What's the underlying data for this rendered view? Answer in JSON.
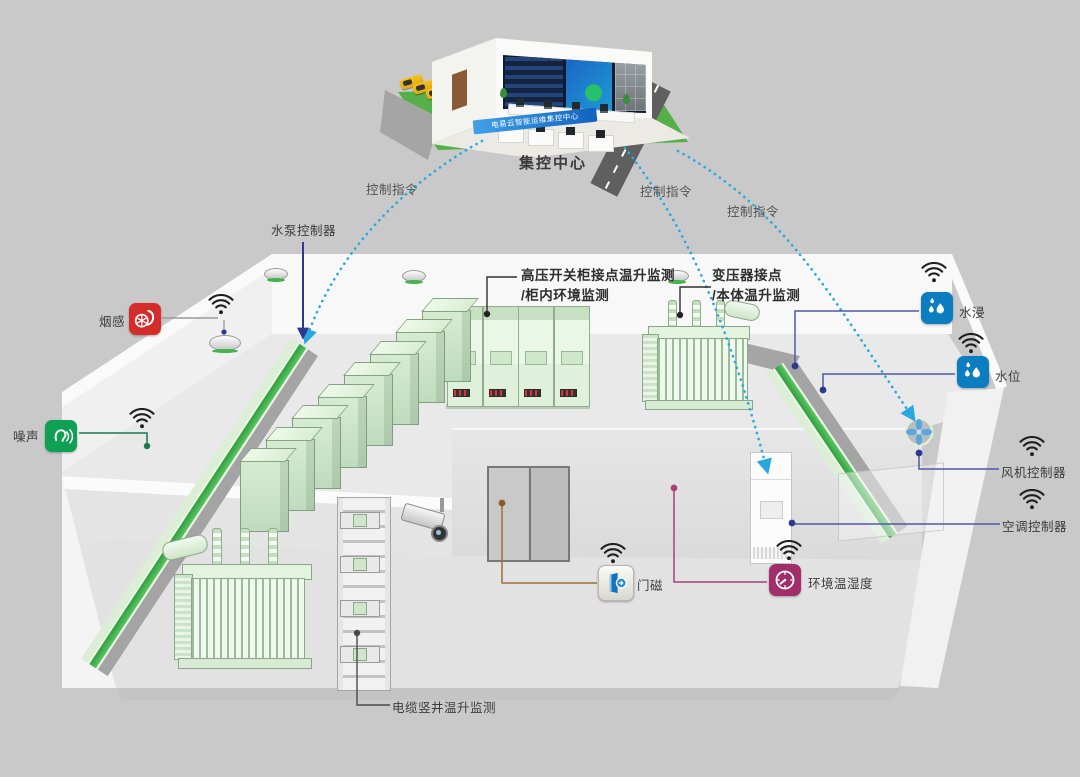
{
  "control_center": {
    "label": "集控中心",
    "banner": "电易云智能运维集控中心"
  },
  "commands": {
    "label": "控制指令"
  },
  "callouts": {
    "water_pump": {
      "label": "水泵控制器"
    },
    "smoke": {
      "label": "烟感"
    },
    "noise": {
      "label": "噪声"
    },
    "hv_cabinet": {
      "line1": "高压开关柜接点温升监测",
      "line2": "/柜内环境监测"
    },
    "transformer": {
      "line1": "变压器接点",
      "line2": "/本体温升监测"
    },
    "water_immersion": {
      "label": "水浸"
    },
    "water_level": {
      "label": "水位"
    },
    "fan": {
      "label": "风机控制器"
    },
    "ac": {
      "label": "空调控制器"
    },
    "door": {
      "label": "门磁"
    },
    "env": {
      "label": "环境温湿度"
    },
    "cable_shaft": {
      "label": "电缆竖井温升监测"
    }
  },
  "palette": {
    "bg": "#c9c9c9",
    "command_line": "#29a8e0",
    "pump_line": "#2b3990",
    "indigo_line": "#5058a5",
    "noise_line": "#1a7a4c",
    "door_line": "#a07038",
    "env_line": "#a8417b",
    "smoke_icon": "#d42b2b",
    "noise_icon": "#0fa054",
    "water_icon": "#0d7dc1",
    "env_icon": "#a12d6b",
    "busbar_green": "#3fae4e"
  }
}
